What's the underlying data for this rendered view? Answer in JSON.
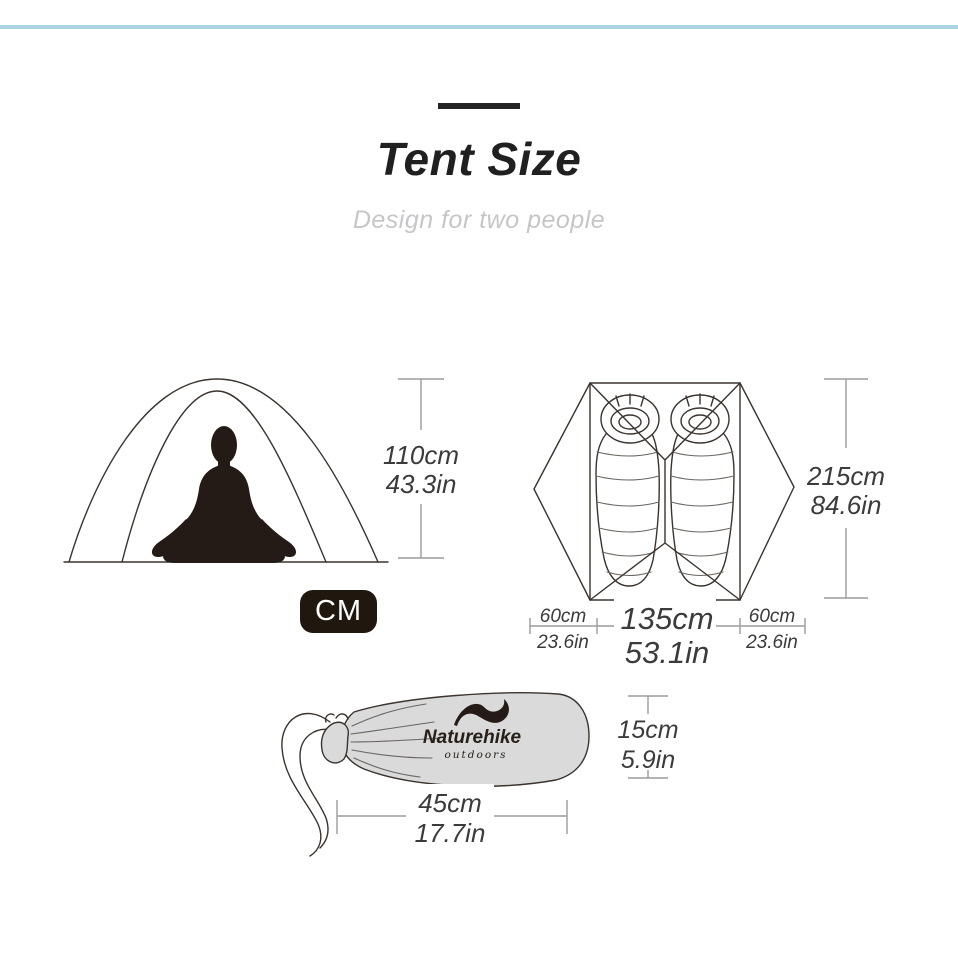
{
  "page": {
    "background_color": "#ffffff",
    "accent_line_color": "#aad5e2"
  },
  "header": {
    "title": "Tent Size",
    "subtitle": "Design for two people"
  },
  "unit_badge": "CM",
  "front_view": {
    "height": {
      "cm": "110cm",
      "inch": "43.3in"
    }
  },
  "top_view": {
    "length": {
      "cm": "215cm",
      "inch": "84.6in"
    },
    "left_vestibule": {
      "cm": "60cm",
      "inch": "23.6in"
    },
    "inner_width": {
      "cm": "135cm",
      "inch": "53.1in"
    },
    "right_vestibule": {
      "cm": "60cm",
      "inch": "23.6in"
    }
  },
  "carry_bag": {
    "brand": "Naturehike",
    "brand_tagline": "outdoors",
    "height": {
      "cm": "15cm",
      "inch": "5.9in"
    },
    "length": {
      "cm": "45cm",
      "inch": "17.7in"
    }
  },
  "colors": {
    "line_art": "#3b332e",
    "dimension_text": "#3b3b3b",
    "dimension_line": "#9b9b9b",
    "bag_fill": "#dadada",
    "badge_background": "#20170f",
    "title_text": "#202020",
    "subtitle_text": "#c6c6c8"
  }
}
